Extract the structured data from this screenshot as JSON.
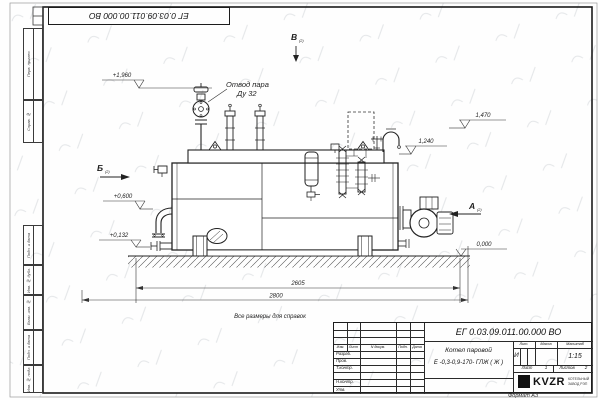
{
  "sheet": {
    "top_stamp_number": "ЕГ 0.03.09.011.00.000  ВО",
    "format_note": "Формат А3",
    "side_labels": [
      "Перв. примен.",
      "Справ. №",
      "Подп. и дата",
      "Инв. № дубл.",
      "Взам. инв. №",
      "Подп. и дата",
      "Инв. № подл."
    ]
  },
  "drawing": {
    "note": "Все размеры для справок",
    "callout": {
      "line1": "Отвод пара",
      "line2": "Ду 32"
    },
    "views": {
      "a": "А",
      "b": "Б",
      "v": "В",
      "ref": "(2)"
    },
    "elevations": {
      "e1": "+1,960",
      "e2": "+0,600",
      "e3": "+0,132",
      "e4": "0,000",
      "e5": "1,240",
      "e6": "1,470"
    },
    "dimensions": {
      "d1": "2605",
      "d2": "2800"
    }
  },
  "title_block": {
    "doc_number": "ЕГ 0.03.09.011.00.000  ВО",
    "product_name": "Котел паровой",
    "product_code": "Е -0,3-0,9-170- ГЛЖ ( Ж )",
    "columns": {
      "izm": "Изм.",
      "list": "Лист",
      "docnum": "N докум.",
      "podp": "Подп.",
      "date": "Дата"
    },
    "roles": {
      "r1": "Разраб.",
      "r2": "Пров.",
      "r3": "Т.контр.",
      "r4": "Н.контр.",
      "r5": "Утв."
    },
    "lit": {
      "label": "Лит.",
      "value": "И"
    },
    "mass": {
      "label": "Масса"
    },
    "scale": {
      "label": "Масштаб",
      "value": "1:15"
    },
    "sheet": {
      "label": "Лист",
      "value": "1"
    },
    "sheets": {
      "label": "Листов",
      "value": "2"
    },
    "logo": {
      "name": "KVZR",
      "sub1": "КОТЕЛЬНЫЙ",
      "sub2": "ЗАВОД РЭП"
    }
  }
}
